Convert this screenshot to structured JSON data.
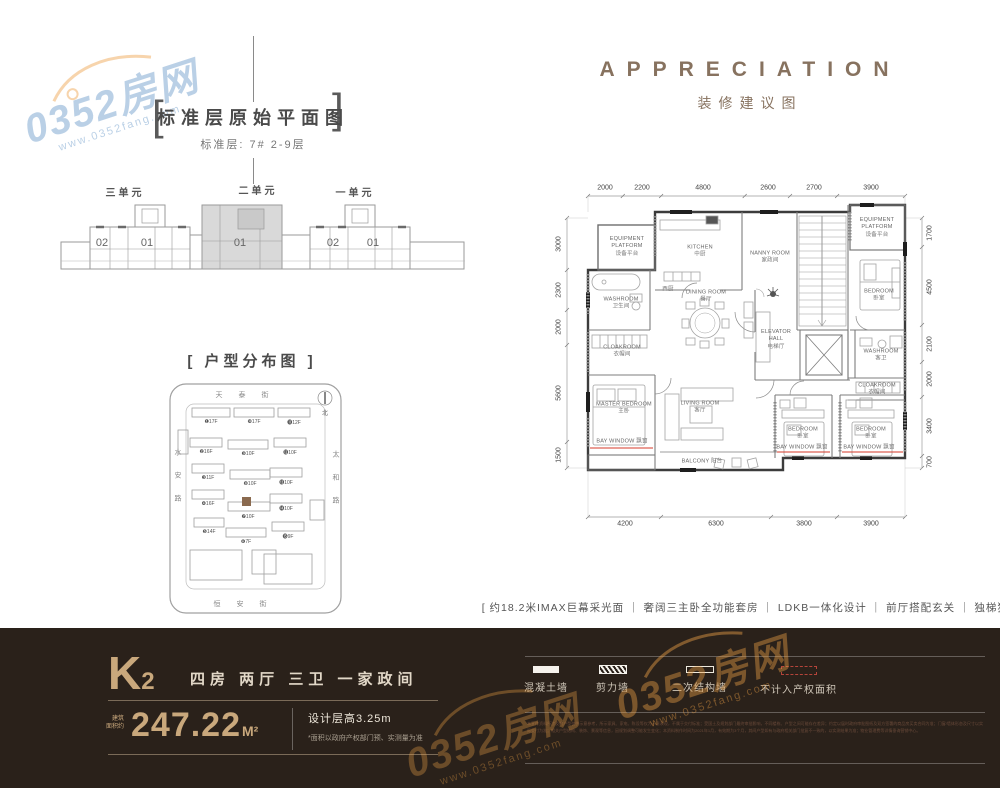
{
  "wm": {
    "brand": "0352房网",
    "site": "www.0352fang.com"
  },
  "std": {
    "bracket_l": "[",
    "bracket_r": "]",
    "title": "标准层原始平面图",
    "subtitle": "标准层: 7#  2-9层",
    "units": [
      {
        "label": "三单元"
      },
      {
        "label": "二单元"
      },
      {
        "label": "一单元"
      }
    ],
    "room_labels": [
      "02",
      "01",
      "01",
      "02",
      "01"
    ]
  },
  "dist": {
    "title": "[ 户型分布图 ]",
    "streets": {
      "top": "天泰街",
      "left": "水安路",
      "right": "太和路",
      "bottom": "恒安街"
    },
    "north": "北",
    "buildings": [
      "❶17F",
      "❿17F",
      "⓫12F",
      "❷16F",
      "❾10F",
      "⓬10F",
      "❸11F",
      "❽10F",
      "⓭10F",
      "❹16F",
      "❼10F",
      "⓮10F",
      "❺14F",
      "❻7F",
      "⓯9F"
    ]
  },
  "app": {
    "title_en": "APPRECIATION",
    "title_cn": "装修建议图",
    "dims": {
      "top": [
        "2000",
        "2200",
        "4800",
        "2600",
        "2700",
        "3900"
      ],
      "bottom": [
        "4200",
        "6300",
        "3800",
        "3900"
      ],
      "left": [
        "3000",
        "2300",
        "2000",
        "5600",
        "1500"
      ],
      "right": [
        "1700",
        "4500",
        "2100",
        "2000",
        "3400",
        "700"
      ]
    },
    "rooms": [
      {
        "en": "EQUIPMENT PLATFORM",
        "cn": "设备平台"
      },
      {
        "en": "KITCHEN",
        "cn": "中厨"
      },
      {
        "en": "NANNY ROOM",
        "cn": "家政间"
      },
      {
        "en": "EQUIPMENT PLATFORM",
        "cn": "设备平台"
      },
      {
        "en": "WASHROOM",
        "cn": "卫生间"
      },
      {
        "en": "",
        "cn": "西厨"
      },
      {
        "en": "DINING ROOM",
        "cn": "餐厅"
      },
      {
        "en": "ELEVATOR HALL",
        "cn": "电梯厅"
      },
      {
        "en": "BEDROOM",
        "cn": "卧室"
      },
      {
        "en": "CLOAKROOM",
        "cn": "衣帽间"
      },
      {
        "en": "WASHROOM",
        "cn": "客卫"
      },
      {
        "en": "CLOAKROOM",
        "cn": "衣帽间"
      },
      {
        "en": "MASTER BEDROOM",
        "cn": "主卧"
      },
      {
        "en": "LIVING ROOM",
        "cn": "客厅"
      },
      {
        "en": "BAY WINDOW",
        "cn": "飘窗"
      },
      {
        "en": "BALCONY",
        "cn": "阳台"
      },
      {
        "en": "BEDROOM",
        "cn": "卧室"
      },
      {
        "en": "BEDROOM",
        "cn": "卧室"
      },
      {
        "en": "BAY WINDOW",
        "cn": "飘窗"
      },
      {
        "en": "BAY WINDOW",
        "cn": "飘窗"
      }
    ],
    "tagline": "[ 约18.2米IMAX巨幕采光面  ｜  奢阔三主卧全功能套房  ｜  LDKB一体化设计 ｜  前厅搭配玄关  ｜  独梯独户 ]"
  },
  "footer": {
    "code": "K",
    "code_sub": "2",
    "layout": "四房  两厅  三卫  一家政间",
    "area_label1": "建筑",
    "area_label2": "面积约",
    "area": "247.22",
    "area_unit": "M²",
    "height": "设计层高3.25m",
    "note": "*面积以政府产权部门预、实测量为准",
    "legend": [
      {
        "label": "混凝土墙"
      },
      {
        "label": "剪力墙"
      },
      {
        "label": "二次结构墙"
      },
      {
        "label": "不计入产权面积"
      }
    ],
    "disclaimer": "本宣传资料所涉及的户型仅供示意参考，所示家具、家电、陈设等仅为示意表现，不属于交付标准；受国土及规划部门最终审批影响，不同楼栋、户型之间可能存在差异；约定以届时政府审批图纸及双方签署的商品房买卖合同为准；门窗/墙体形态及尺寸以实际交付为准；相关户型结构、装饰、景观等信息，因规划调整可能发生变化；本资料制作时间为2021年1月，有效期为3个月，其间户型如有与政府相关部门批复不一致的，以实测结果为准；物业管理费等详情垂询营销中心。"
  }
}
